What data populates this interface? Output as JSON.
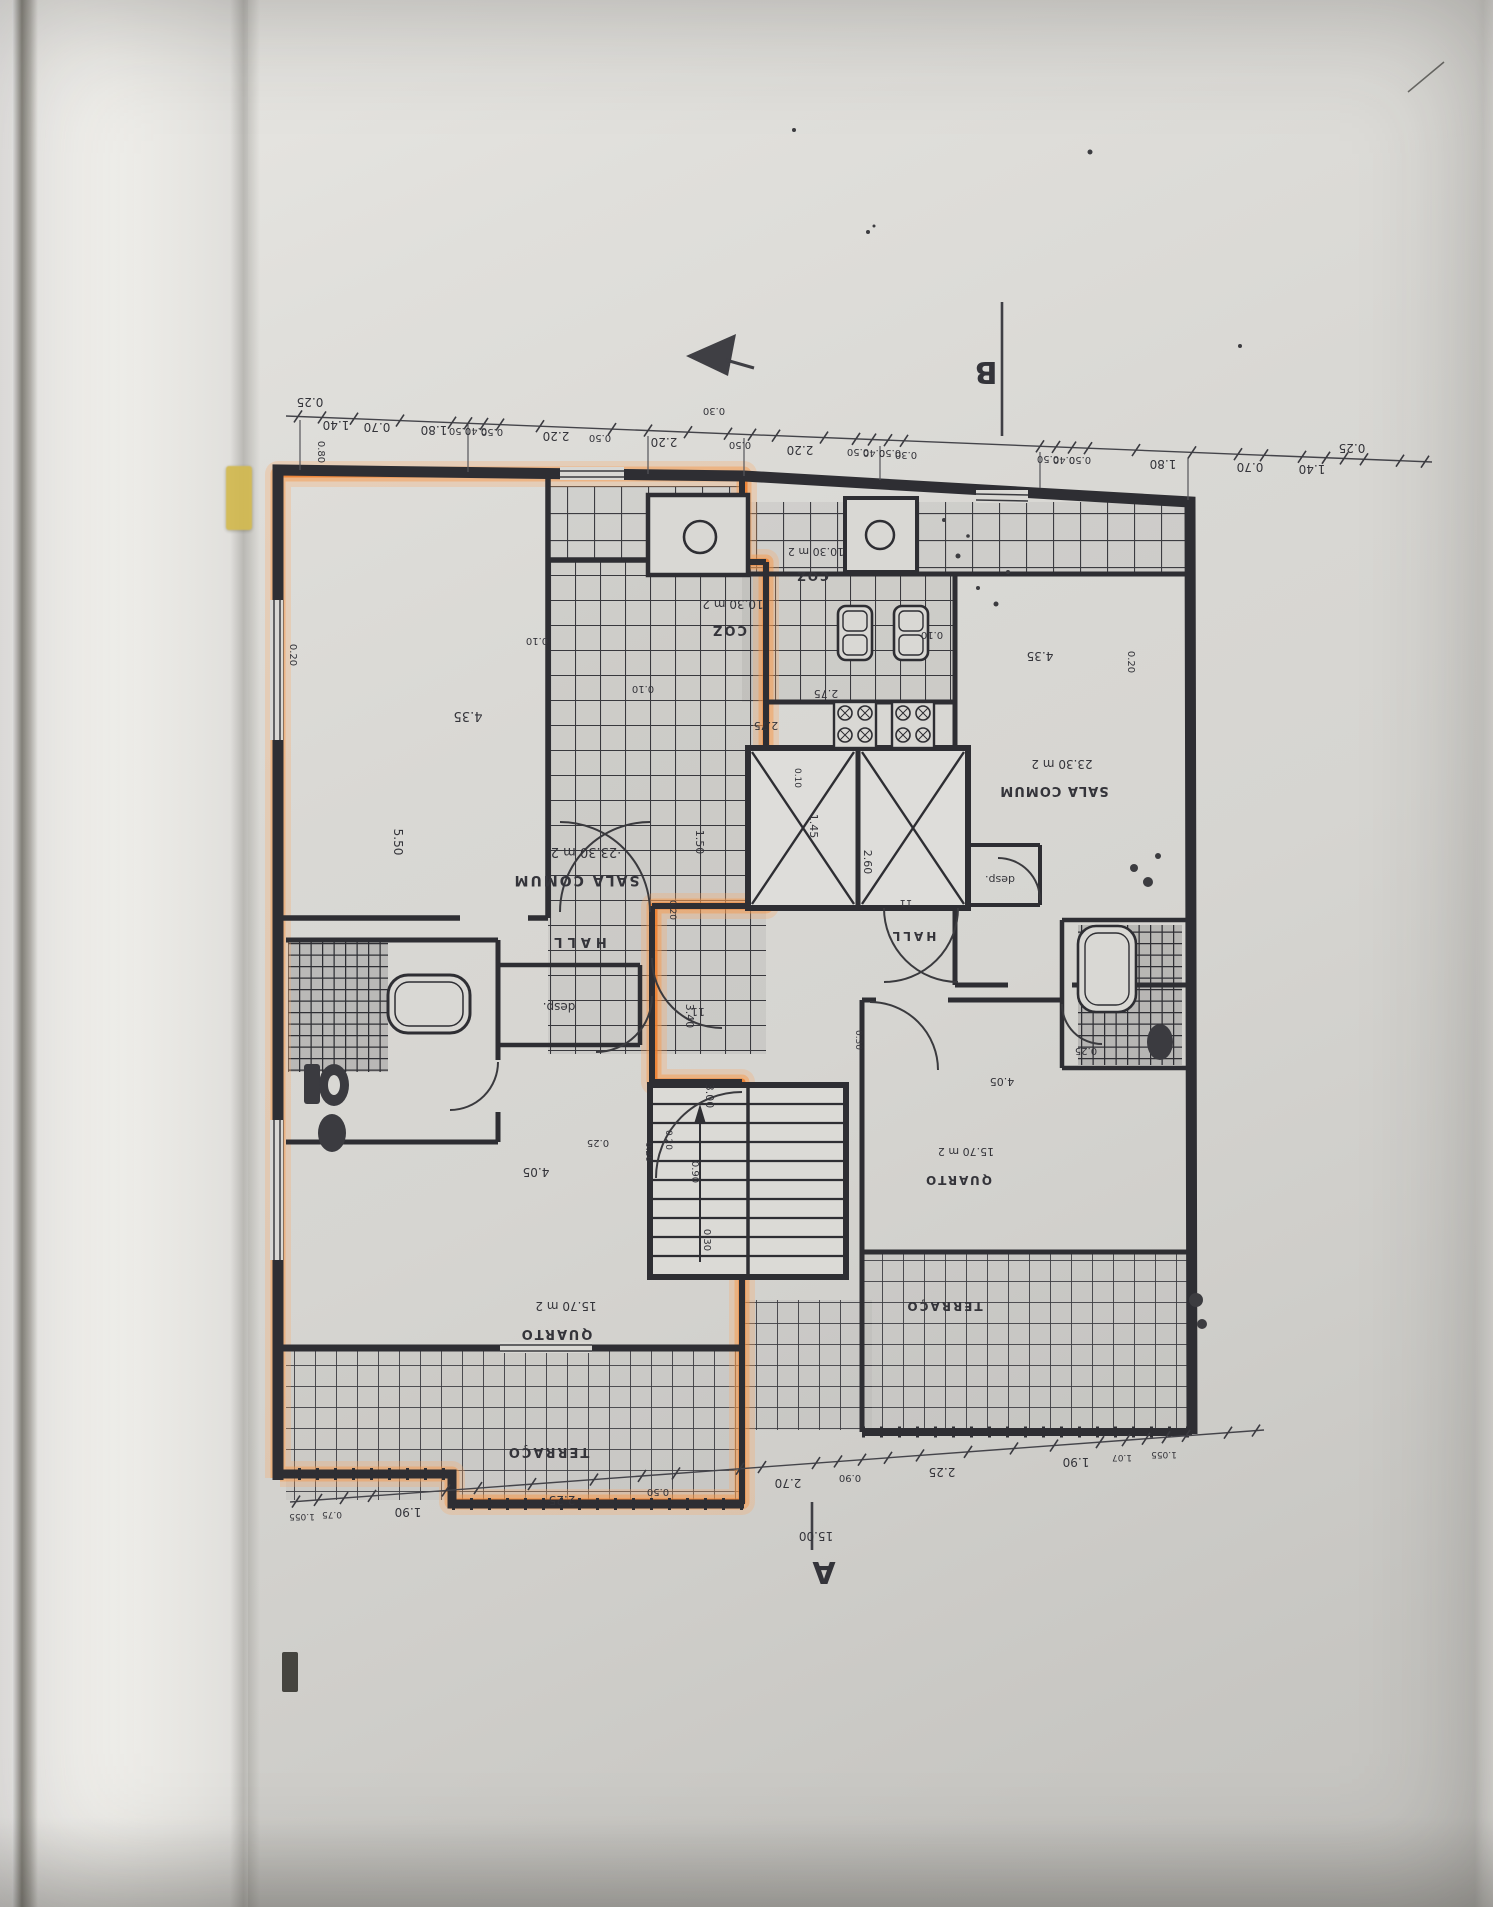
{
  "document_kind": "architectural floor plan photo (drawing printed upside-down)",
  "markers": {
    "section_top": "B",
    "section_bottom": "A",
    "overall_width": "15.00"
  },
  "legend_labels": {
    "living_room": "SALA COMUM",
    "living_room_area": "23.30 m 2",
    "kitchen": "COZ",
    "kitchen_area": "10.30 m 2",
    "bedroom": "QUARTO",
    "bedroom_area": "15.70 m 2",
    "hall": "HALL",
    "pantry": "desp.",
    "terrace": "TERRAÇO",
    "door_tag": "11"
  },
  "highlight_color": "#ee7f35",
  "dims_top": [
    "0.25",
    "1.40",
    "0.70",
    "1.80",
    "0.50",
    "0.40",
    "0.50",
    "2.20",
    "0.50",
    "2.20",
    "0.50",
    "2.20",
    "0.50",
    "0.40",
    "0.50",
    "0.50",
    "0.40",
    "0.50",
    "1.80",
    "0.70",
    "1.40",
    "0.25"
  ],
  "dims_bottom": [
    "1.055",
    "0.75",
    "1.90",
    "2.25",
    "0.50",
    "2.70",
    "0.90",
    "2.25",
    "1.90",
    "1.07",
    "1.055",
    "15.00"
  ],
  "plan_texts": [
    {
      "t": "0.25",
      "x": 310,
      "y": 398
    },
    {
      "t": "1.40",
      "x": 336,
      "y": 421
    },
    {
      "t": "0.70",
      "x": 377,
      "y": 423
    },
    {
      "t": "1.80",
      "x": 434,
      "y": 426
    },
    {
      "t": "0.50",
      "x": 460,
      "y": 428,
      "s": 10
    },
    {
      "t": "0.40",
      "x": 476,
      "y": 428,
      "s": 10
    },
    {
      "t": "0.50",
      "x": 492,
      "y": 429,
      "s": 10
    },
    {
      "t": "2.20",
      "x": 556,
      "y": 432
    },
    {
      "t": "0.50",
      "x": 600,
      "y": 435,
      "s": 10
    },
    {
      "t": "2.20",
      "x": 664,
      "y": 438
    },
    {
      "t": "0.50",
      "x": 740,
      "y": 442,
      "s": 10
    },
    {
      "t": "2.20",
      "x": 800,
      "y": 446
    },
    {
      "t": "0.50",
      "x": 858,
      "y": 449,
      "s": 10
    },
    {
      "t": "0.40",
      "x": 874,
      "y": 450,
      "s": 10
    },
    {
      "t": "0.50",
      "x": 890,
      "y": 450,
      "s": 10
    },
    {
      "t": "0.50",
      "x": 1048,
      "y": 456,
      "s": 10
    },
    {
      "t": "0.40",
      "x": 1064,
      "y": 457,
      "s": 10
    },
    {
      "t": "0.50",
      "x": 1080,
      "y": 457,
      "s": 10
    },
    {
      "t": "1.80",
      "x": 1163,
      "y": 460
    },
    {
      "t": "0.70",
      "x": 1250,
      "y": 463
    },
    {
      "t": "1.40",
      "x": 1312,
      "y": 465
    },
    {
      "t": "0.25",
      "x": 1352,
      "y": 444
    },
    {
      "t": "0.80",
      "x": 318,
      "y": 452,
      "r": 90,
      "s": 10
    },
    {
      "t": "0.20",
      "x": 290,
      "y": 655,
      "r": 90,
      "s": 10
    },
    {
      "t": "5.50",
      "x": 394,
      "y": 842,
      "r": 90,
      "s": 12
    },
    {
      "t": "0.20",
      "x": 1128,
      "y": 662,
      "r": 90,
      "s": 10
    },
    {
      "t": "0.30",
      "x": 714,
      "y": 408,
      "s": 10
    },
    {
      "t": "0.30",
      "x": 906,
      "y": 452,
      "s": 10
    },
    {
      "t": "0.10",
      "x": 537,
      "y": 638,
      "s": 10
    },
    {
      "t": "0.10",
      "x": 932,
      "y": 632,
      "s": 10
    },
    {
      "t": "10.30 m 2",
      "x": 733,
      "y": 600,
      "s": 12,
      "n": "room-area"
    },
    {
      "t": "COZ",
      "x": 729,
      "y": 626,
      "s": 13,
      "b": 1,
      "ls": 2,
      "n": "room-label"
    },
    {
      "t": "10.30 m 2",
      "x": 816,
      "y": 548,
      "s": 11,
      "n": "room-area"
    },
    {
      "t": "COZ",
      "x": 812,
      "y": 572,
      "s": 12,
      "b": 1,
      "ls": 2,
      "n": "room-label"
    },
    {
      "t": "2.75",
      "x": 766,
      "y": 722,
      "s": 11
    },
    {
      "t": "2.75",
      "x": 826,
      "y": 690,
      "s": 11
    },
    {
      "t": "0.10",
      "x": 643,
      "y": 686,
      "s": 10
    },
    {
      "t": "0.10",
      "x": 795,
      "y": 778,
      "r": 90,
      "s": 9
    },
    {
      "t": "1.45",
      "x": 810,
      "y": 826,
      "r": 90,
      "s": 11
    },
    {
      "t": "1.50",
      "x": 696,
      "y": 842,
      "r": 90,
      "s": 11
    },
    {
      "t": "0.20",
      "x": 670,
      "y": 910,
      "r": 90,
      "s": 9
    },
    {
      "t": "2.60",
      "x": 864,
      "y": 862,
      "r": 90,
      "s": 11
    },
    {
      "t": "3.40",
      "x": 686,
      "y": 1016,
      "r": 90,
      "s": 11
    },
    {
      "t": "3.00",
      "x": 706,
      "y": 1096,
      "r": 90,
      "s": 11
    },
    {
      "t": "0.20",
      "x": 666,
      "y": 1140,
      "r": 90,
      "s": 9
    },
    {
      "t": "0.90",
      "x": 692,
      "y": 1172,
      "r": 90,
      "s": 10
    },
    {
      "t": "0.30",
      "x": 704,
      "y": 1240,
      "r": 90,
      "s": 10
    },
    {
      "t": "4.35",
      "x": 468,
      "y": 712,
      "s": 13
    },
    {
      "t": "·23.30 m 2",
      "x": 586,
      "y": 848,
      "s": 13,
      "n": "room-area"
    },
    {
      "t": "SALA COMUM",
      "x": 576,
      "y": 876,
      "s": 14,
      "b": 1,
      "ls": 2,
      "n": "room-label"
    },
    {
      "t": "HALL",
      "x": 578,
      "y": 938,
      "s": 13,
      "b": 1,
      "ls": 5,
      "n": "room-label"
    },
    {
      "t": "desp.",
      "x": 559,
      "y": 1003,
      "s": 12,
      "n": "room-label"
    },
    {
      "t": "11",
      "x": 698,
      "y": 1008,
      "s": 11,
      "n": "door-tag"
    },
    {
      "t": "0.25",
      "x": 598,
      "y": 1140,
      "s": 10
    },
    {
      "t": "0.20",
      "x": 646,
      "y": 1152,
      "r": 90,
      "s": 9
    },
    {
      "t": "4.05",
      "x": 536,
      "y": 1168,
      "s": 12
    },
    {
      "t": "15.70 m 2",
      "x": 566,
      "y": 1302,
      "s": 12,
      "n": "room-area"
    },
    {
      "t": "QUARTO",
      "x": 556,
      "y": 1330,
      "s": 13,
      "b": 1,
      "ls": 2,
      "n": "room-label"
    },
    {
      "t": "TERRAÇO",
      "x": 548,
      "y": 1448,
      "s": 13,
      "b": 1,
      "ls": 2,
      "n": "room-label"
    },
    {
      "t": "4.35",
      "x": 1040,
      "y": 652,
      "s": 12
    },
    {
      "t": "23.30 m 2",
      "x": 1062,
      "y": 760,
      "s": 12,
      "n": "room-area"
    },
    {
      "t": "SALA COMUM",
      "x": 1054,
      "y": 787,
      "s": 13,
      "b": 1,
      "ls": 1,
      "n": "room-label"
    },
    {
      "t": "desp.",
      "x": 1000,
      "y": 876,
      "s": 11,
      "n": "room-label"
    },
    {
      "t": "11",
      "x": 906,
      "y": 900,
      "s": 10,
      "n": "door-tag"
    },
    {
      "t": "HALL",
      "x": 913,
      "y": 932,
      "s": 12,
      "b": 1,
      "ls": 3,
      "n": "room-label"
    },
    {
      "t": "0.25",
      "x": 1086,
      "y": 1048,
      "s": 10
    },
    {
      "t": "4.05",
      "x": 1002,
      "y": 1078,
      "s": 11
    },
    {
      "t": "0.30",
      "x": 856,
      "y": 1040,
      "r": 90,
      "s": 9
    },
    {
      "t": "15.70 m 2",
      "x": 966,
      "y": 1148,
      "s": 11,
      "n": "room-area"
    },
    {
      "t": "QUARTO",
      "x": 958,
      "y": 1176,
      "s": 12,
      "b": 1,
      "ls": 2,
      "n": "room-label"
    },
    {
      "t": "TERRAÇO",
      "x": 944,
      "y": 1302,
      "s": 12,
      "b": 1,
      "ls": 2,
      "n": "room-label"
    },
    {
      "t": "1.055",
      "x": 302,
      "y": 1514,
      "s": 9
    },
    {
      "t": "0.75",
      "x": 332,
      "y": 1512,
      "s": 9
    },
    {
      "t": "1.90",
      "x": 408,
      "y": 1508
    },
    {
      "t": "2.25",
      "x": 562,
      "y": 1496
    },
    {
      "t": "0.50",
      "x": 658,
      "y": 1489,
      "s": 10
    },
    {
      "t": "2.70",
      "x": 788,
      "y": 1479
    },
    {
      "t": "0.90",
      "x": 850,
      "y": 1475,
      "s": 10
    },
    {
      "t": "2.25",
      "x": 942,
      "y": 1468
    },
    {
      "t": "1.90",
      "x": 1076,
      "y": 1458
    },
    {
      "t": "1.07",
      "x": 1122,
      "y": 1455,
      "s": 9
    },
    {
      "t": "1.055",
      "x": 1164,
      "y": 1452,
      "s": 9
    },
    {
      "t": "15.00",
      "x": 816,
      "y": 1532,
      "s": 12,
      "n": "overall-dimension"
    },
    {
      "t": "B",
      "x": 986,
      "y": 362,
      "s": 30,
      "b": 1,
      "n": "section-marker-b"
    },
    {
      "t": "A",
      "x": 824,
      "y": 1562,
      "s": 30,
      "b": 1,
      "n": "section-marker-a"
    }
  ],
  "dim_lines": [
    {
      "x1": 286,
      "y1": 416,
      "x2": 1432,
      "y2": 462,
      "ticks": [
        298,
        322,
        354,
        400,
        452,
        468,
        484,
        500,
        540,
        612,
        648,
        688,
        728,
        752,
        776,
        824,
        856,
        872,
        888,
        904,
        1040,
        1056,
        1072,
        1088,
        1136,
        1192,
        1238,
        1264,
        1302,
        1326,
        1344,
        1364,
        1400,
        1425
      ]
    },
    {
      "x1": 290,
      "y1": 1502,
      "x2": 1264,
      "y2": 1430,
      "ticks": [
        296,
        318,
        344,
        372,
        446,
        478,
        532,
        594,
        642,
        676,
        740,
        762,
        816,
        838,
        862,
        888,
        920,
        968,
        1014,
        1054,
        1100,
        1126,
        1146,
        1166,
        1186,
        1228,
        1256
      ]
    }
  ]
}
